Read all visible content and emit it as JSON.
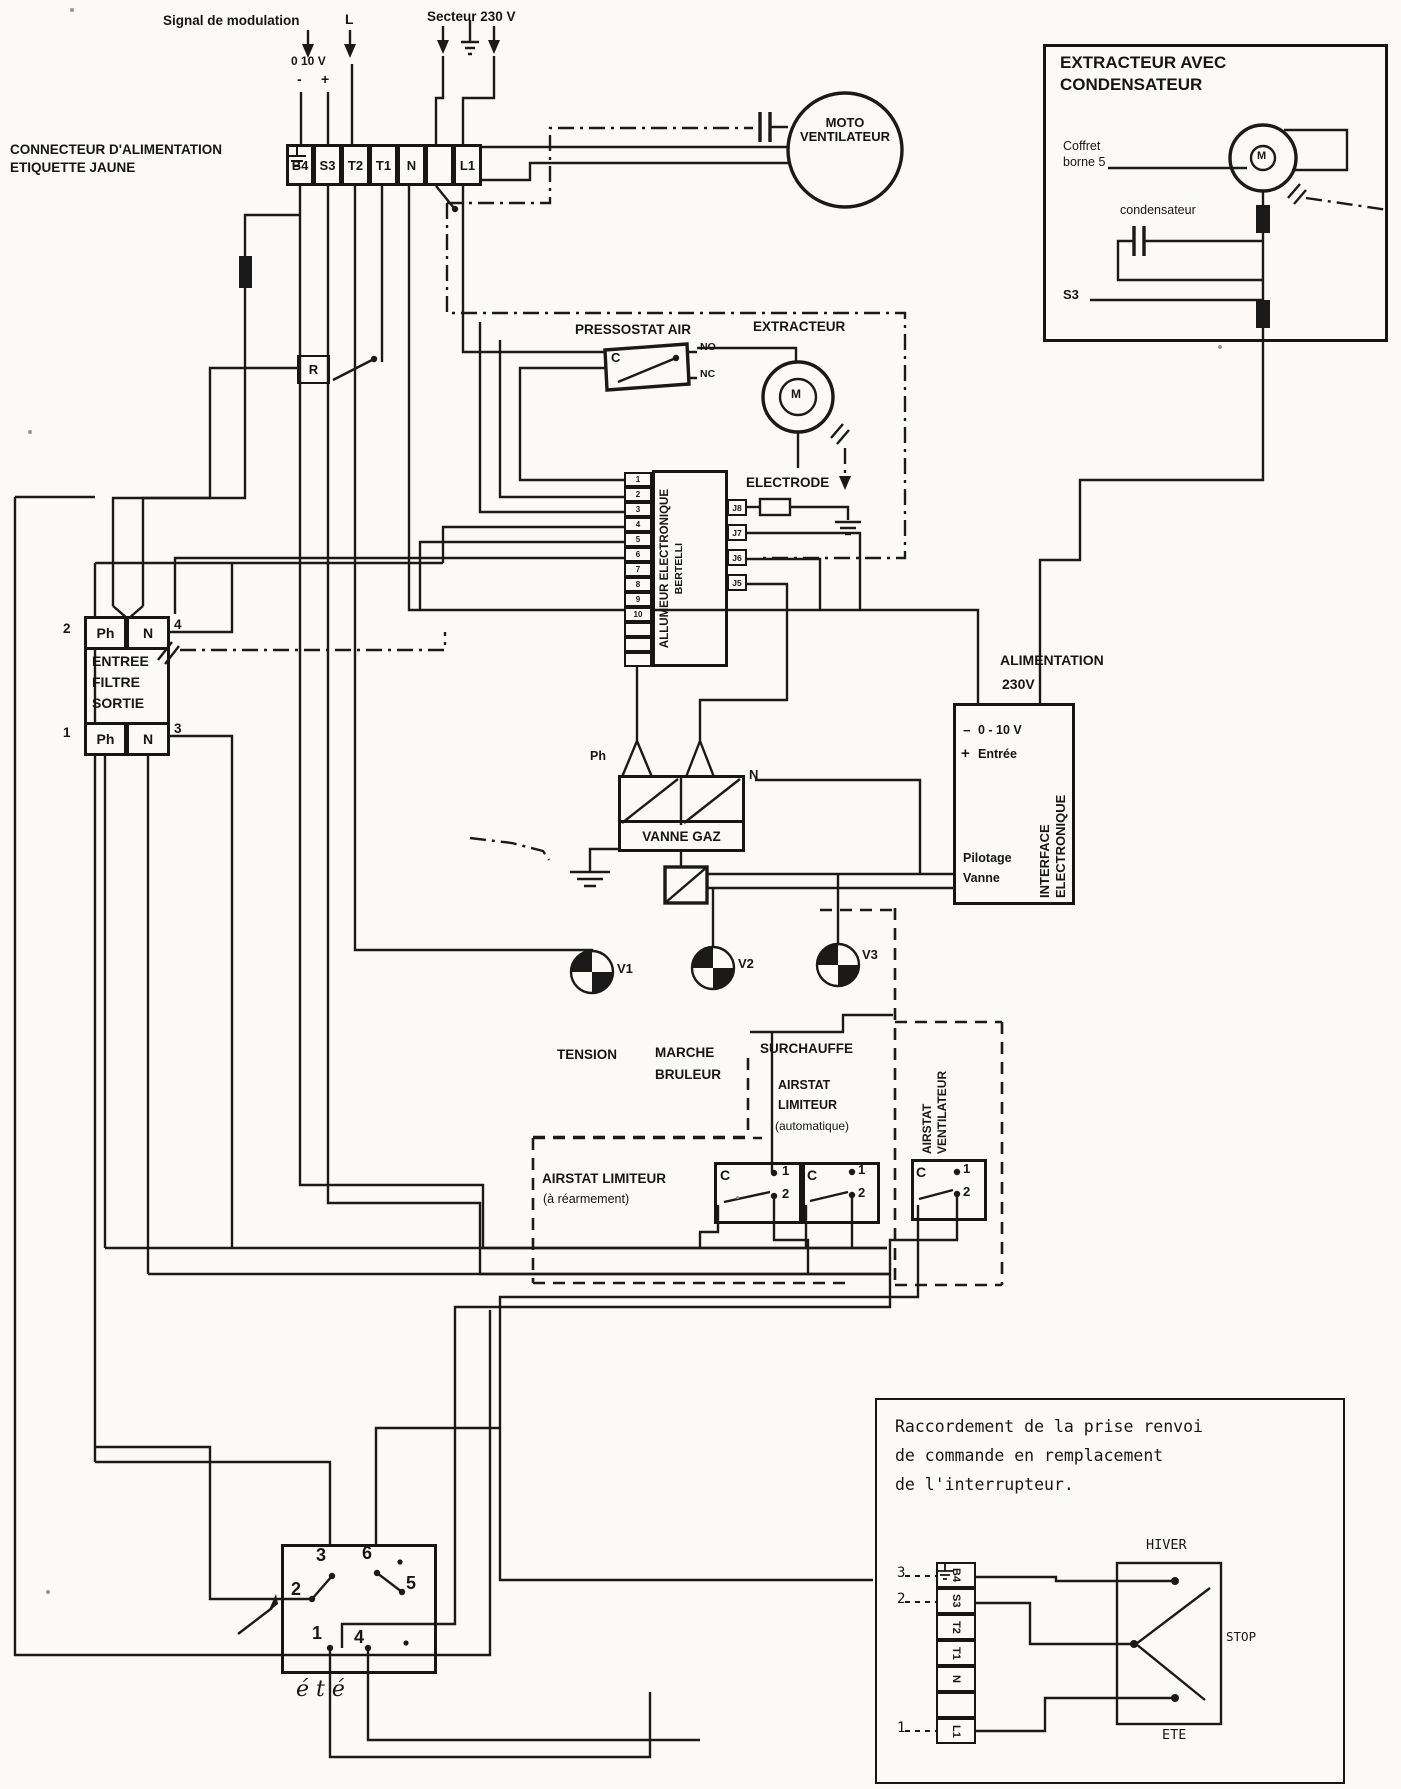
{
  "top": {
    "signal_modulation": "Signal de modulation",
    "scale": "0 10 V",
    "minus": "-",
    "plus": "+",
    "l": "L",
    "secteur": "Secteur 230 V",
    "connecteur_l1": "CONNECTEUR D'ALIMENTATION",
    "connecteur_l2": "ETIQUETTE JAUNE",
    "terminals": [
      "B4",
      "S3",
      "T2",
      "T1",
      "N",
      "L1"
    ]
  },
  "moto": {
    "l1": "MOTO",
    "l2": "VENTILATEUR"
  },
  "extracteur_box": {
    "title1": "EXTRACTEUR AVEC",
    "title2": "CONDENSATEUR",
    "coffret1": "Coffret",
    "coffret2": "borne 5",
    "condensateur": "condensateur",
    "m": "M",
    "s3": "S3"
  },
  "pressostat": {
    "title": "PRESSOSTAT AIR",
    "c": "C",
    "no": "NO",
    "nc": "NC"
  },
  "extracteur": {
    "title": "EXTRACTEUR",
    "m": "M"
  },
  "relay": {
    "r": "R"
  },
  "allumeur": {
    "title1": "ALLUMEUR ELECTRONIQUE",
    "title2": "BERTELLI",
    "pins": [
      "1",
      "2",
      "3",
      "4",
      "5",
      "6",
      "7",
      "8",
      "9",
      "10"
    ],
    "pins_right": [
      "J8",
      "J7",
      "J6",
      "J5"
    ]
  },
  "electrode": {
    "label": "ELECTRODE"
  },
  "filtre": {
    "n2": "2",
    "n4": "4",
    "n1": "1",
    "n3": "3",
    "ph": "Ph",
    "n": "N",
    "l1": "ENTREE",
    "l2": "FILTRE",
    "l3": "SORTIE"
  },
  "vanne": {
    "title": "VANNE GAZ",
    "ph": "Ph",
    "n": "N"
  },
  "alim": {
    "l1": "ALIMENTATION",
    "l2": "230V"
  },
  "interface": {
    "minus": "−",
    "v010": "0 - 10 V",
    "plus": "+",
    "entree": "Entrée",
    "pilotage1": "Pilotage",
    "pilotage2": "Vanne",
    "vert1": "INTERFACE",
    "vert2": "ELECTRONIQUE"
  },
  "lamps": {
    "v1": "V1",
    "v2": "V2",
    "v3": "V3",
    "tension": "TENSION",
    "marche1": "MARCHE",
    "marche2": "BRULEUR",
    "surchauffe": "SURCHAUFFE"
  },
  "airstat": {
    "auto1": "AIRSTAT",
    "auto2": "LIMITEUR",
    "auto3": "(automatique)",
    "rearm1": "AIRSTAT LIMITEUR",
    "rearm2": "(à réarmement)",
    "vent1": "AIRSTAT",
    "vent2": "VENTILATEUR",
    "c": "C",
    "one": "1",
    "two": "2"
  },
  "ete_switch": {
    "n3": "3",
    "n6": "6",
    "n2": "2",
    "n5": "5",
    "n1": "1",
    "n4": "4",
    "label": "été"
  },
  "raccordement": {
    "title1": "Raccordement de la prise renvoi",
    "title2": "de commande en remplacement",
    "title3": "de l'interrupteur.",
    "terminals": [
      "B4",
      "S3",
      "T2",
      "T1",
      "N",
      "L1"
    ],
    "n3": "3",
    "n2": "2",
    "n1": "1",
    "hiver": "HIVER",
    "stop": "STOP",
    "ete": "ETE"
  }
}
